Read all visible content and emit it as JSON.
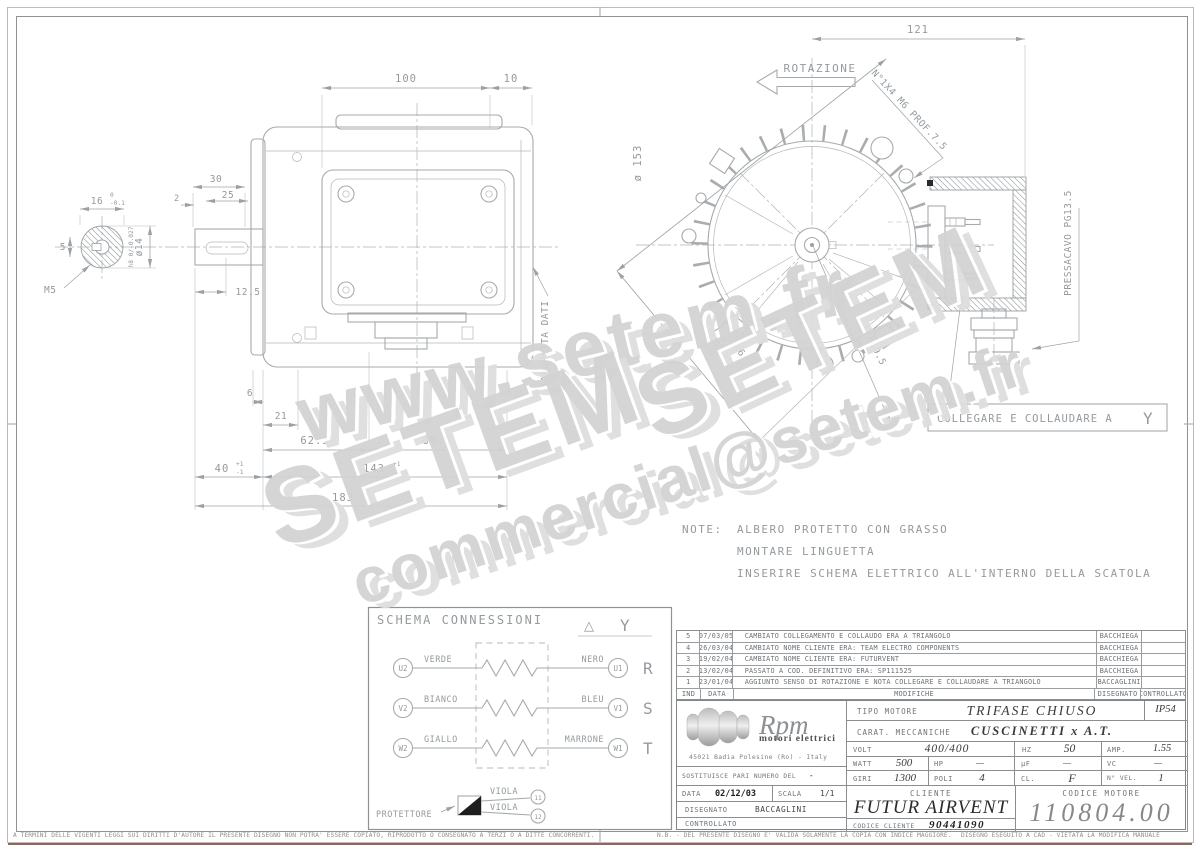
{
  "watermark": {
    "www": "www.setem.fr",
    "setem1": "SETEM",
    "setem2": "SETEM",
    "email": "commercial@setem.fr"
  },
  "shaft_end": {
    "dim_16": "16",
    "tol_top": "0",
    "tol_bot": "-0.1",
    "dim_5": "5",
    "thread": "M5",
    "dia": "ø14",
    "fit": "h8 0/-0.027"
  },
  "shaft": {
    "dim_30": "30",
    "dim_2": "2",
    "dim_25": "25",
    "dim_12_5": "12.5"
  },
  "side_view": {
    "dim_100": "100",
    "dim_10": "10",
    "dim_6": "6",
    "dim_21": "21",
    "dim_62_5": "62.5",
    "dim_80_5": "80.5",
    "dim_40": "40",
    "tol_40_top": "+1",
    "tol_40_bot": "-1",
    "dim_143": "143",
    "tol_143_top": "+1",
    "tol_143_bot": "-1",
    "dim_183": "183",
    "tol_183_top": "+2",
    "tol_183_bot": "-2",
    "targhetta": "TARGHETTA DATI"
  },
  "front_view": {
    "dim_121": "121",
    "rotation": "ROTAZIONE",
    "holes": "N°1X4 M6 PROF.7.5",
    "dia": "ø 153",
    "dim_146": "146",
    "radius": "R69.5",
    "gland": "PRESSACAVO PG13.5",
    "connect_note": "COLLEGARE E COLLAUDARE A",
    "wye": "Y"
  },
  "note": {
    "label": "NOTE:",
    "lines": [
      "ALBERO PROTETTO CON GRASSO",
      "MONTARE LINGUETTA",
      "INSERIRE SCHEMA ELETTRICO ALL'INTERNO DELLA SCATOLA"
    ]
  },
  "schema": {
    "title": "SCHEMA CONNESSIONI",
    "delta": "△",
    "wye": "Y",
    "rows": [
      {
        "left_id": "U2",
        "left_color": "VERDE",
        "right_color": "NERO",
        "right_id": "U1",
        "phase": "R"
      },
      {
        "left_id": "V2",
        "left_color": "BIANCO",
        "right_color": "BLEU",
        "right_id": "V1",
        "phase": "S"
      },
      {
        "left_id": "W2",
        "left_color": "GIALLO",
        "right_color": "MARRONE",
        "right_id": "W1",
        "phase": "T"
      }
    ],
    "protector": {
      "label": "PROTETTORE",
      "wire1": "VIOLA",
      "wire2": "VIOLA",
      "terminal1": "11",
      "terminal2": "12"
    }
  },
  "revisions": {
    "headers": {
      "ind": "IND",
      "data": "DATA",
      "modifiche": "MODIFICHE",
      "disegnato": "DISEGNATO",
      "controllato": "CONTROLLATO"
    },
    "rows": [
      {
        "ind": "5",
        "date": "07/03/05",
        "text": "CAMBIATO COLLEGAMENTO E COLLAUDO ERA A TRIANGOLO",
        "by": "BACCHIEGA"
      },
      {
        "ind": "4",
        "date": "26/03/04",
        "text": "CAMBIATO NOME CLIENTE ERA: TEAM ELECTRO COMPONENTS",
        "by": "BACCHIEGA"
      },
      {
        "ind": "3",
        "date": "19/02/04",
        "text": "CAMBIATO NOME CLIENTE ERA: FUTURVENT",
        "by": "BACCHIEGA"
      },
      {
        "ind": "2",
        "date": "13/02/04",
        "text": "PASSATO A COD. DEFINITIVO ERA: SP111525",
        "by": "BACCHIEGA"
      },
      {
        "ind": "1",
        "date": "23/01/04",
        "text": "AGGIUNTO SENSO DI ROTAZIONE E NOTA COLLEGARE E COLLAUDARE A TRIANGOLO",
        "by": "BACCAGLINI"
      }
    ]
  },
  "titleblock": {
    "logo": {
      "name": "Rpm",
      "subtitle": "motori elettrici",
      "address": "45021 Badia Polesine (Ro) - Italy"
    },
    "tipo_label": "TIPO MOTORE",
    "tipo": "TRIFASE CHIUSO",
    "ip": "IP54",
    "carat_label": "CARAT. MECCANICHE",
    "carat": "CUSCINETTI x A.T.",
    "volt_label": "VOLT",
    "volt": "400/400",
    "hz_label": "HZ",
    "hz": "50",
    "amp_label": "AMP.",
    "amp": "1.55",
    "watt_label": "WATT",
    "watt": "500",
    "hp_label": "HP",
    "hp": "—",
    "uf_label": "µF",
    "uf": "—",
    "vc_label": "VC",
    "vc": "—",
    "giri_label": "GIRI",
    "giri": "1300",
    "poli_label": "POLI",
    "poli": "4",
    "cl_label": "CL.",
    "cl": "F",
    "nvel_label": "N° VEL.",
    "nvel": "1",
    "sost_label": "SOSTITUISCE PARI NUMERO DEL",
    "sost": "-",
    "data_label": "DATA",
    "data": "02/12/03",
    "scala_label": "SCALA",
    "scala": "1/1",
    "disegnato_label": "DISEGNATO",
    "disegnato": "BACCAGLINI",
    "controllato_label": "CONTROLLATO",
    "cliente_label": "CLIENTE",
    "cliente": "FUTUR AIRVENT",
    "codcli_label": "CODICE CLIENTE",
    "codcli": "90441090",
    "codmot_label": "CODICE MOTORE",
    "codmot": "110804.00"
  },
  "footer": {
    "left": "A TERMINI DELLE VIGENTI LEGGI SUI DIRITTI D'AUTORE IL PRESENTE DISEGNO NON POTRA' ESSERE COPIATO, RIPRODOTTO O CONSEGNATO A TERZI O A DITTE CONCORRENTI.",
    "mid": "N.B. - DEL PRESENTE DISEGNO E' VALIDA SOLAMENTE LA COPIA CON INDICE MAGGIORE.",
    "right": "DISEGNO ESEGUITO A CAD - VIETATA LA MODIFICA MANUALE"
  }
}
